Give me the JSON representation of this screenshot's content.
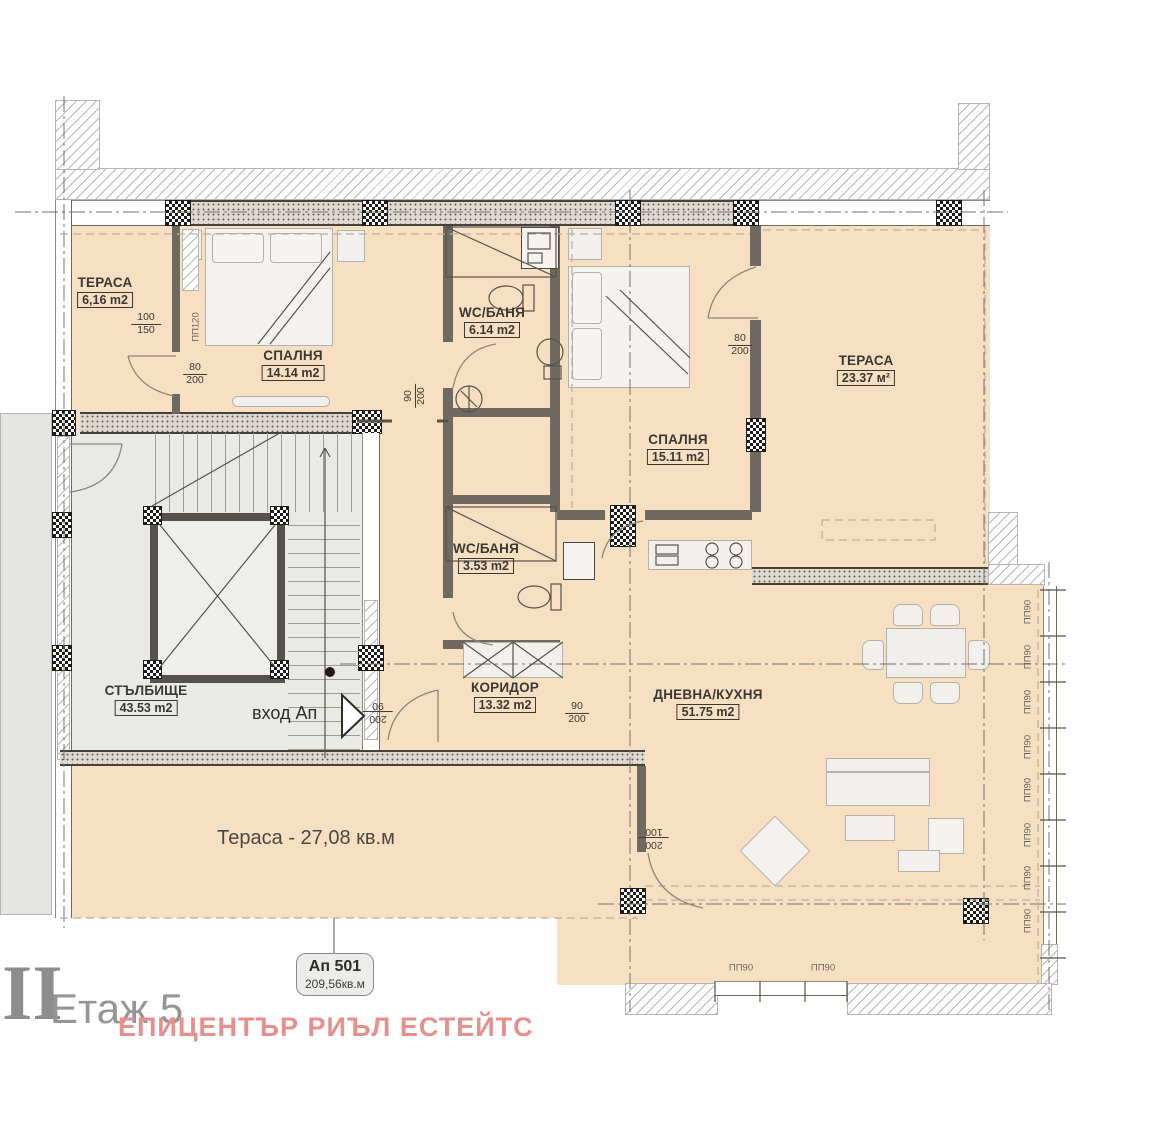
{
  "floor": {
    "roman": "II",
    "label": "Етаж 5"
  },
  "apartment_tag": {
    "id": "Ап 501",
    "area": "209,56кв.м"
  },
  "watermark": {
    "text": "ЕПИЦЕНТЪР РИЪЛ ЕСТЕЙТС",
    "color": "#e5908d"
  },
  "rooms": [
    {
      "id": "terrace-left",
      "name": "ТЕРАСА",
      "area": "6,16 m2"
    },
    {
      "id": "bedroom-1",
      "name": "СПАЛНЯ",
      "area": "14.14 m2"
    },
    {
      "id": "bath-1",
      "name": "WC/БАНЯ",
      "area": "6.14 m2"
    },
    {
      "id": "bedroom-2",
      "name": "СПАЛНЯ",
      "area": "15.11 m2"
    },
    {
      "id": "terrace-right",
      "name": "ТЕРАСА",
      "area": "23.37 м²"
    },
    {
      "id": "staircase",
      "name": "СТЪЛБИЩЕ",
      "area": "43.53 m2"
    },
    {
      "id": "bath-2",
      "name": "WC/БАНЯ",
      "area": "3.53 m2"
    },
    {
      "id": "corridor",
      "name": "КОРИДОР",
      "area": "13.32 m2"
    },
    {
      "id": "living-kitchen",
      "name": "ДНЕВНА/КУХНЯ",
      "area": "51.75 m2"
    }
  ],
  "terrace_bottom": {
    "label": "Тераса - 27,08 кв.м"
  },
  "entrance": {
    "label": "вход Ап"
  },
  "dimensions": [
    {
      "top": "100",
      "bottom": "150"
    },
    {
      "top": "80",
      "bottom": "200"
    },
    {
      "top": "90",
      "bottom": "200"
    },
    {
      "top": "80",
      "bottom": "200"
    },
    {
      "top": "90",
      "bottom": "200"
    },
    {
      "top": "200",
      "bottom": "90"
    },
    {
      "top": "200",
      "bottom": "100"
    }
  ],
  "window_labels": {
    "right": [
      "ПП90",
      "ПП90",
      "ПП90",
      "ПП90",
      "ПП90",
      "ПП90",
      "ПП90",
      "ПП90"
    ],
    "bottom": [
      "ПП90",
      "ПП90"
    ],
    "partition": "ПП120"
  },
  "colors": {
    "floor": "#f7dfc2",
    "stair_floor": "#e9e9e6",
    "watermark": "#e5908d"
  }
}
